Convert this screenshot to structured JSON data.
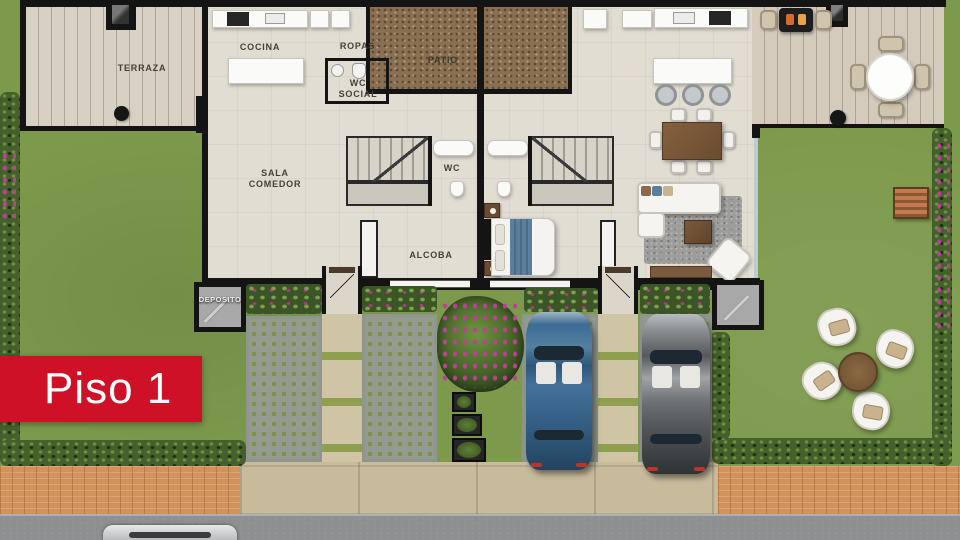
{
  "banner": {
    "label": "Piso 1"
  },
  "rooms": {
    "terraza": "TERRAZA",
    "cocina": "COCINA",
    "ropas": "ROPAS",
    "patio": "PATIO",
    "wc_social": "WC SOCIAL",
    "sala_comedor": "SALA COMEDOR",
    "wc": "WC",
    "alcoba": "ALCOBA",
    "deposito": "DEPOSITO"
  },
  "palette": {
    "banner_red": "#ce1126",
    "banner_text": "#ffffff",
    "label_text": "#454139",
    "wall_black": "#141414",
    "interior_floor": "#e1ddd3",
    "deck_wood": "#d8d1c3",
    "grass": "#7d9a4c",
    "hedge_green": "#45602c",
    "gravel_patio": "#8a7052",
    "paver_gray": "#8e968e",
    "paver_grass": "#7f9348",
    "stepping_stone": "#cfc4a4",
    "brick_sidewalk": "#d2925c",
    "concrete_sidewalk": "#c7bb9c",
    "road_gray": "#8d8f91",
    "car_blue": "#3c6b94",
    "car_gray": "#4d5154",
    "street_car_silver": "#c6c8ca",
    "wood_brown": "#7a5a3d",
    "bed_runner_blue": "#5d7f9e",
    "rug_gray": "#9c9c9a",
    "flower_magenta": "#b5338f"
  }
}
